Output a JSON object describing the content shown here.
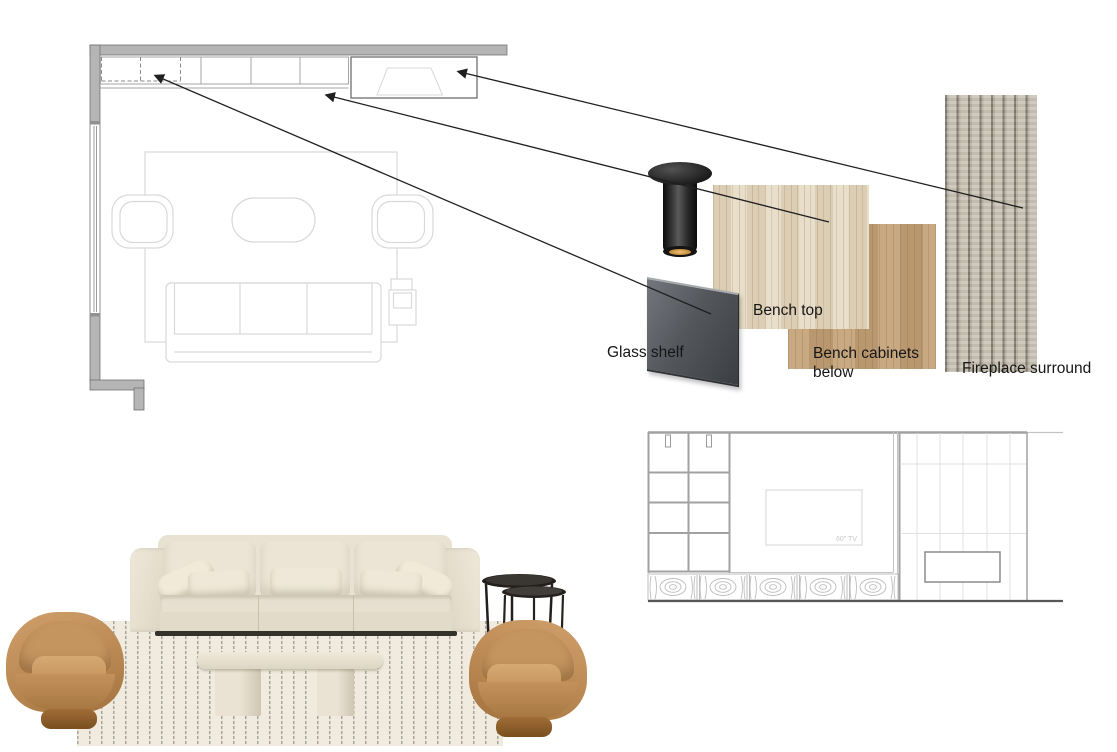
{
  "annotations": {
    "glass_shelf": "Glass shelf",
    "bench_top": "Bench top",
    "bench_cabinets": "Bench cabinets below",
    "fireplace_surround": "Fireplace surround"
  },
  "elevation": {
    "tv_label": "60\" TV"
  },
  "colors": {
    "background": "#ffffff",
    "wall_gray": "#b5b5b5",
    "plan_furniture_line": "#d9d9d9",
    "cabinet_line": "#a6a6a6",
    "arrow_black": "#1f1f1f",
    "travertine_beige": "#e0d5c1",
    "wood_veneer_tan": "#c3a27a",
    "fluted_stone_greige": "#c8c2b4",
    "glass_dark_gray": "#54575c",
    "sofa_cream": "#e9e2d3",
    "leather_camel": "#b4824c",
    "rug_cream": "#f0ebde",
    "nesting_table_black": "#221f1c",
    "elevation_line": "#a2a2a2"
  }
}
